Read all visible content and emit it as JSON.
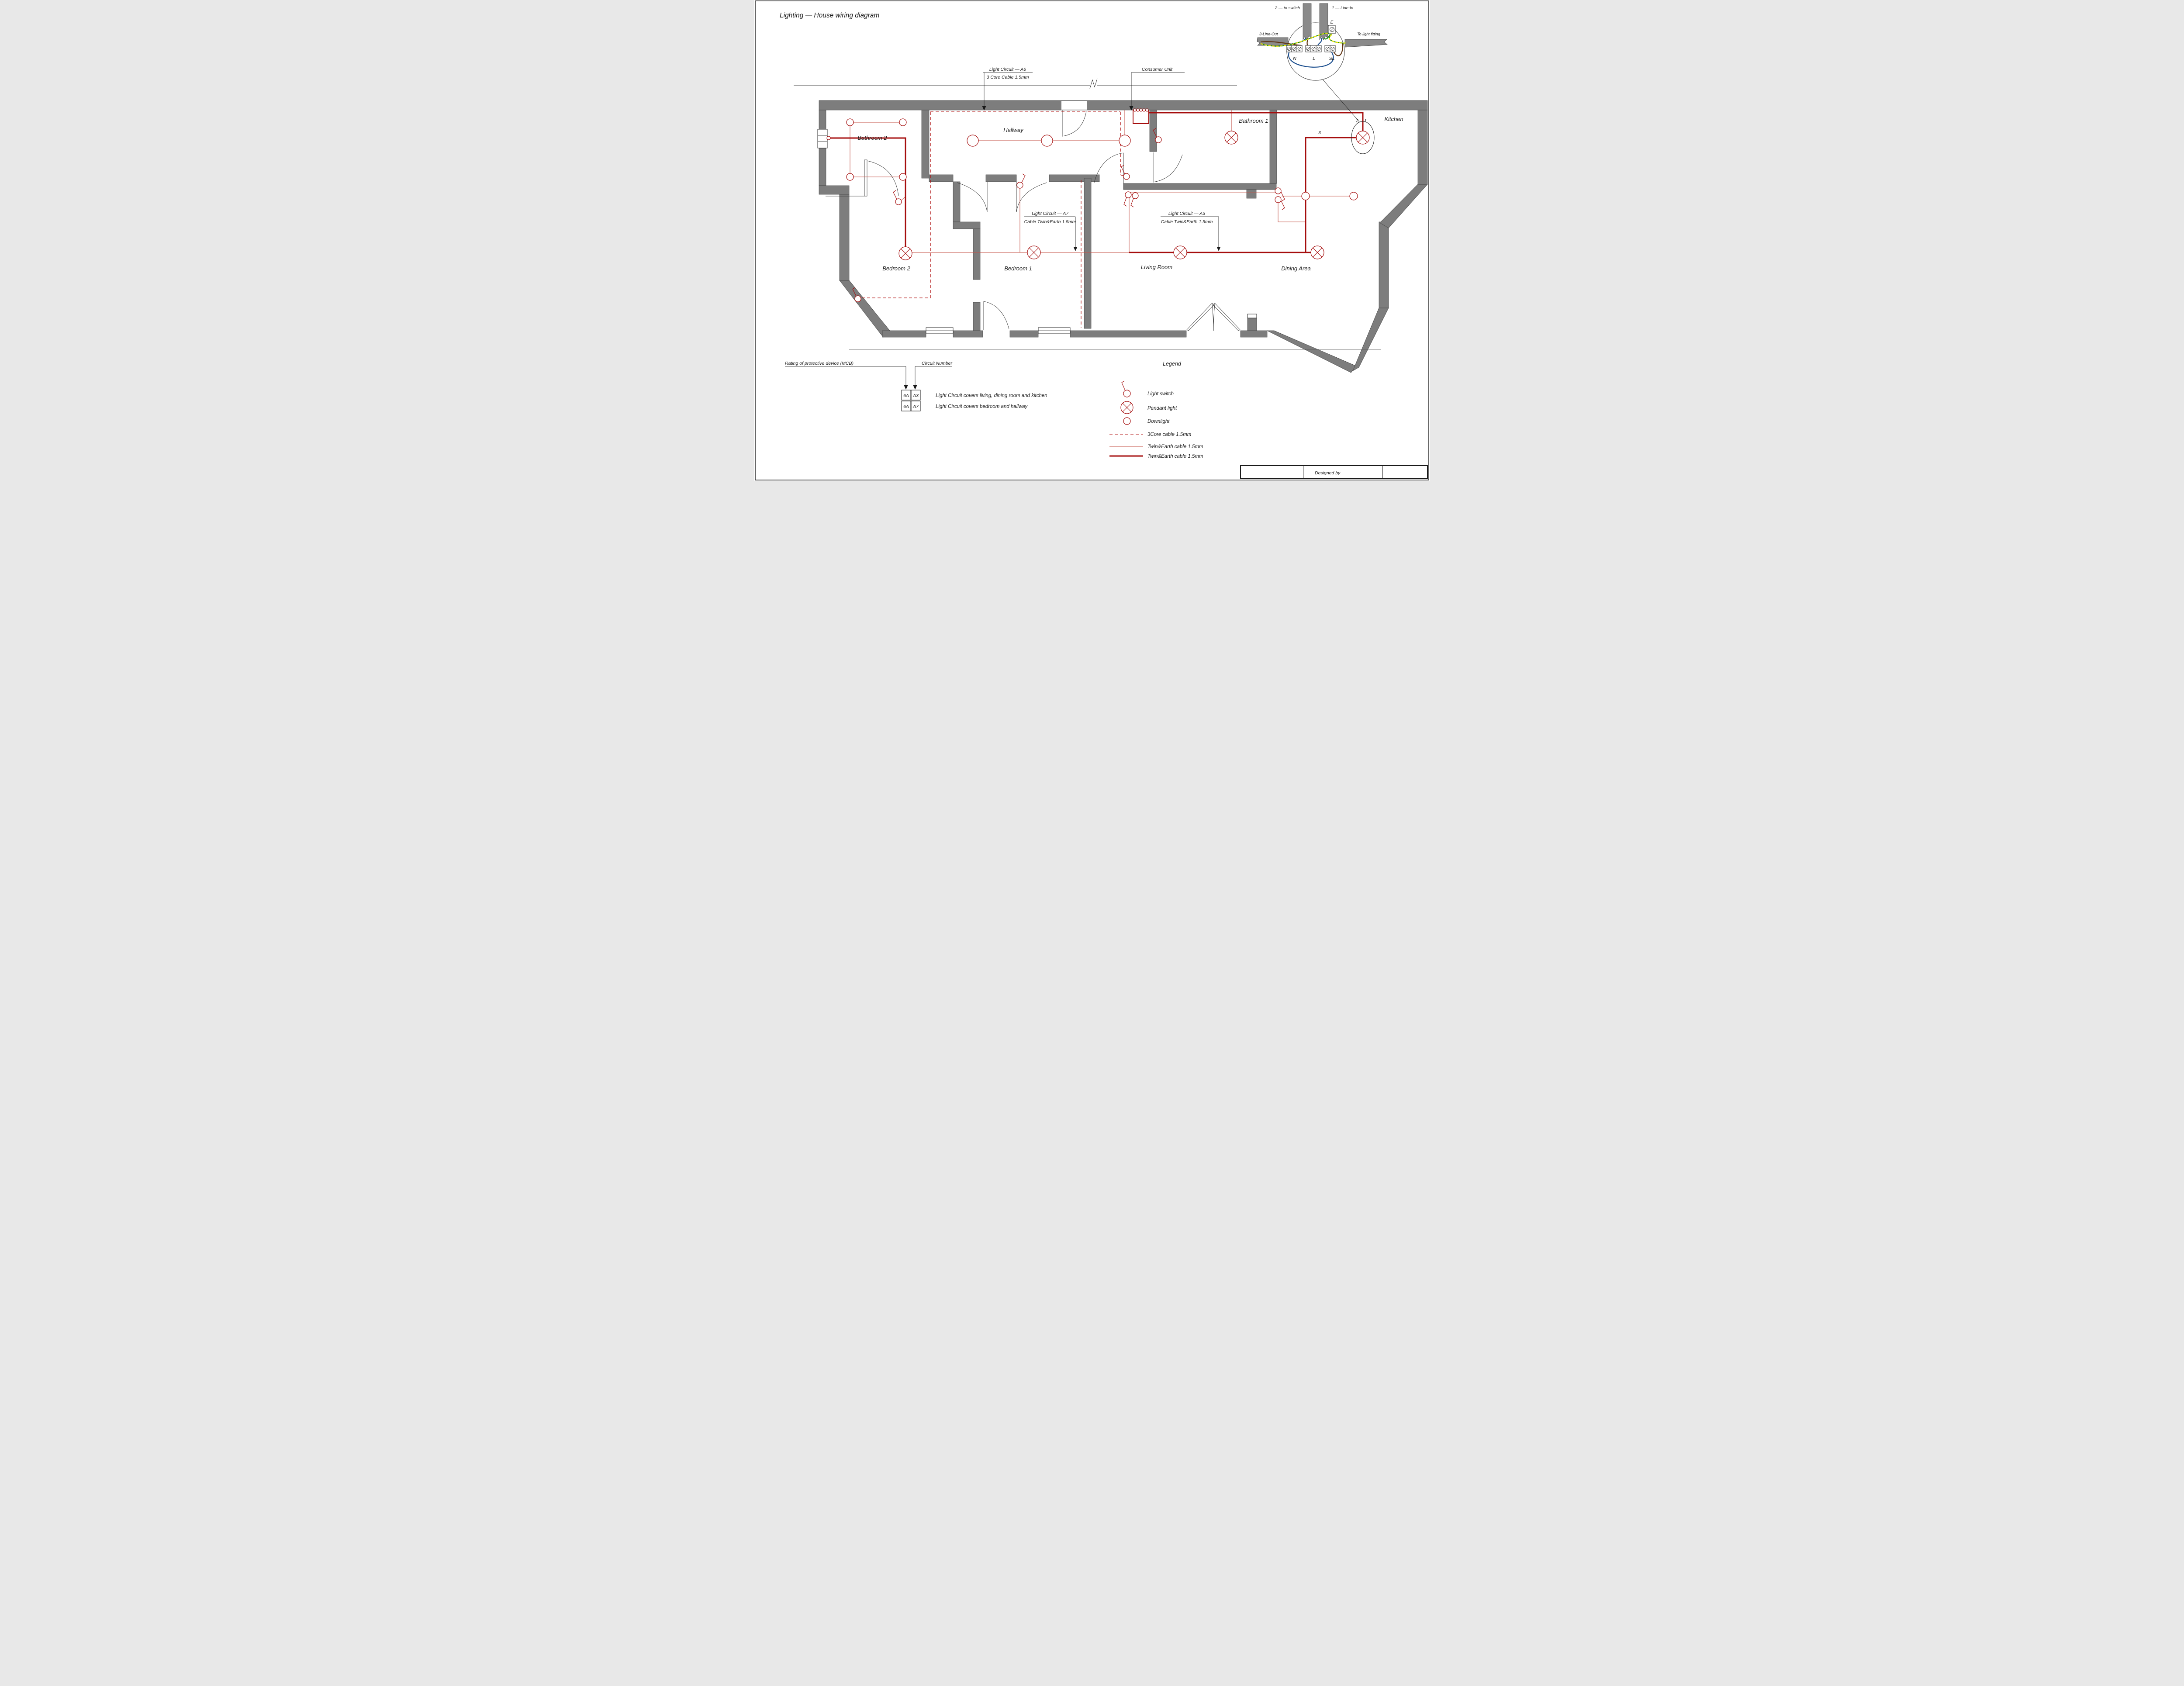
{
  "page": {
    "title": "Lighting — House wiring diagram"
  },
  "detail": {
    "label_to_switch": "2 — to switch",
    "label_line_in": "1 — Line-In",
    "label_line_out": "3-Line-Out",
    "label_to_light_fitting": "To light fitting",
    "terminal_e": "E",
    "terminal_n": "N",
    "terminal_l": "L",
    "terminal_sl": "SL"
  },
  "annotations": {
    "a6": {
      "line1": "Light Circuit — A6",
      "line2": "3 Core Cable 1.5mm"
    },
    "consumer_unit": "Consumer Unit",
    "a7": {
      "line1": "Light Circuit — A7",
      "line2": "Cable Twin&Earth 1.5mm"
    },
    "a3": {
      "line1": "Light Circuit — A3",
      "line2": "Cable Twin&Earth 1.5mm"
    }
  },
  "rooms": {
    "bathroom2": "Bathroom 2",
    "hallway": "Hallway",
    "bathroom1": "Bathroom 1",
    "kitchen": "Kitchen",
    "bedroom2": "Bedroom 2",
    "bedroom1": "Bedroom 1",
    "living": "Living Room",
    "dining": "Dining Area"
  },
  "kitchen_pendant": {
    "n1": "1",
    "n2": "2",
    "n3": "3"
  },
  "mcb": {
    "rating_label": "Rating of protective device (MCB)",
    "circuit_label": "Circuit Number",
    "rows": [
      {
        "rating": "6A",
        "circuit": "A3",
        "desc": "Light Circuit covers living, dining room and kitchen"
      },
      {
        "rating": "6A",
        "circuit": "A7",
        "desc": "Light Circuit covers bedroom and hallway"
      }
    ]
  },
  "legend": {
    "title": "Legend",
    "switch": "Light switch",
    "pendant": "Pendant light",
    "downlight": "Downlight",
    "cable3": "3Core cable 1.5mm",
    "cable_thin": "Twin&Earth cable 1.5mm",
    "cable_thick": "Twin&Earth cable 1.5mm"
  },
  "titleblock": {
    "designed_by": "Designed by"
  },
  "colors": {
    "wire_red": "#a50d0d",
    "wall_gray": "#7d7d7d",
    "neutral_blue": "#1b4e8e",
    "line_brown": "#5f3413",
    "earth_green": "#168a16",
    "earth_yellow": "#efe400"
  }
}
